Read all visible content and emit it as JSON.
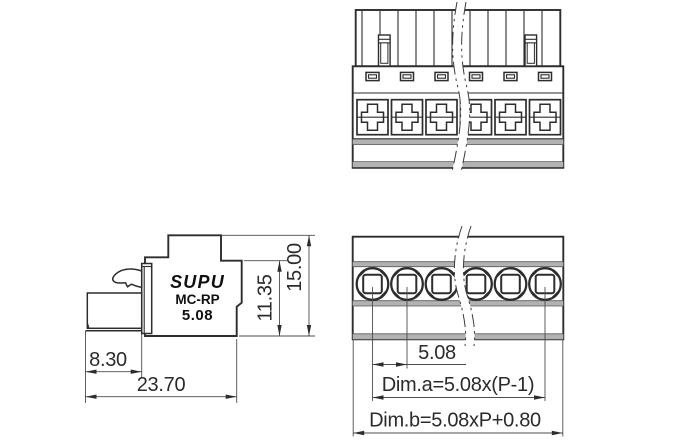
{
  "drawing": {
    "product": {
      "brand": "SUPU",
      "series": "MC-RP",
      "pitch_mm": "5.08",
      "positions_shown": 6
    },
    "side_view": {
      "logo": "SUPU",
      "series_label": "MC-RP",
      "pitch_label": "5.08",
      "dims": {
        "plug_depth": "8.30",
        "total_depth": "23.70",
        "body_height": "11.35",
        "total_height": "15.00"
      }
    },
    "plan_view": {
      "dims": {
        "pitch": "5.08",
        "dim_a": "Dim.a=5.08x(P-1)",
        "dim_b": "Dim.b=5.08xP+0.80"
      }
    },
    "colors": {
      "line": "#2d2d2d",
      "thin_line": "#4d4d4d",
      "gray_fill": "#b2b2b2",
      "text": "#2b2b2b",
      "background": "#ffffff"
    }
  }
}
